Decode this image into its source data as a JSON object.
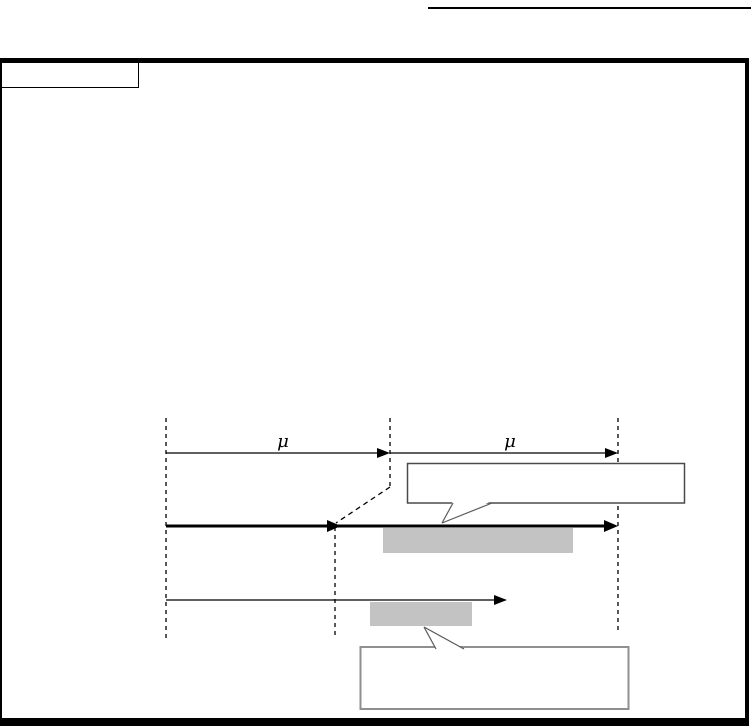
{
  "section_box": {
    "text": ""
  },
  "diagram": {
    "mu_label_left": "μ",
    "mu_label_right": "μ",
    "callout_upper_text": "",
    "callout_lower_text": ""
  },
  "colors": {
    "line": "#000000",
    "gray_fill": "#c3c3c3",
    "callout_upper_border": "#4a4a4a",
    "callout_lower_border": "#8f8f8f",
    "tail_stroke": "#5a5a5a"
  }
}
